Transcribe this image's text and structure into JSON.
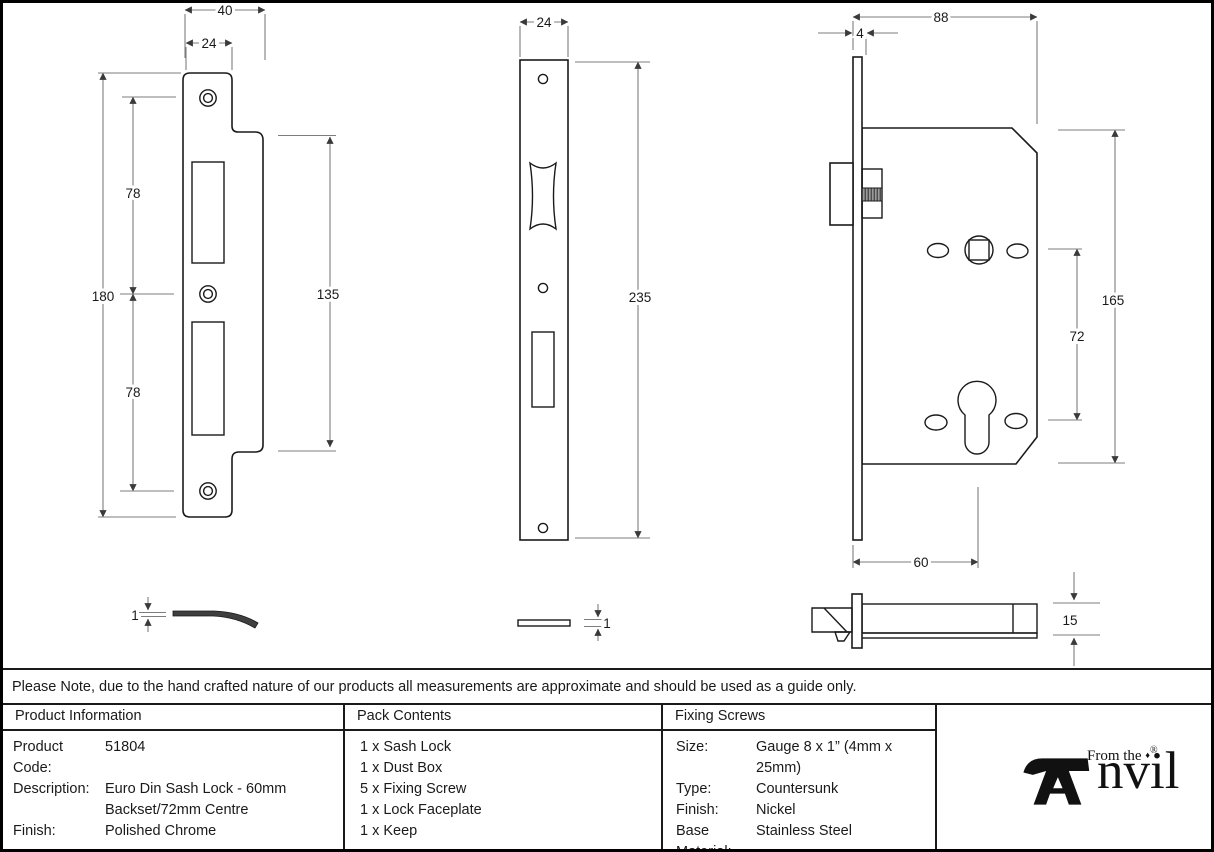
{
  "note": "Please Note, due to the hand crafted nature of our products all measurements are approximate and should be used as a guide only.",
  "drawings": {
    "keep": {
      "width_outer": "40",
      "width_inner": "24",
      "height": "180",
      "top_segment": "78",
      "bottom_segment": "78",
      "lip_height": "135",
      "thickness": "1"
    },
    "faceplate": {
      "width": "24",
      "height": "235",
      "thickness": "1"
    },
    "lock_body": {
      "width": "88",
      "faceplate_thickness": "4",
      "height": "165",
      "centre": "72",
      "backset": "60",
      "case_depth": "15"
    }
  },
  "table": {
    "product_info": {
      "header": "Product Information",
      "rows": [
        {
          "label": "Product Code:",
          "value": "51804"
        },
        {
          "label": "Description:",
          "value": "Euro Din Sash Lock - 60mm"
        },
        {
          "label": "",
          "value": "Backset/72mm Centre"
        },
        {
          "label": "Finish:",
          "value": "Polished Chrome"
        }
      ]
    },
    "pack_contents": {
      "header": "Pack Contents",
      "items": [
        "1 x Sash Lock",
        "1 x Dust Box",
        "5 x Fixing Screw",
        "1 x Lock Faceplate",
        "1 x Keep"
      ]
    },
    "fixing_screws": {
      "header": "Fixing Screws",
      "rows": [
        {
          "label": "Size:",
          "value": "Gauge 8 x 1” (4mm x 25mm)"
        },
        {
          "label": "Type:",
          "value": "Countersunk"
        },
        {
          "label": "Finish:",
          "value": "Nickel"
        },
        {
          "label": "Base Material:",
          "value": "Stainless Steel"
        }
      ]
    }
  },
  "logo": {
    "tagline": "From the",
    "diamond": "♦",
    "name_rest": "nvil",
    "registered": "®"
  },
  "colors": {
    "line": "#1a1a1a",
    "dim": "#7d7d7d",
    "text": "#111111"
  }
}
